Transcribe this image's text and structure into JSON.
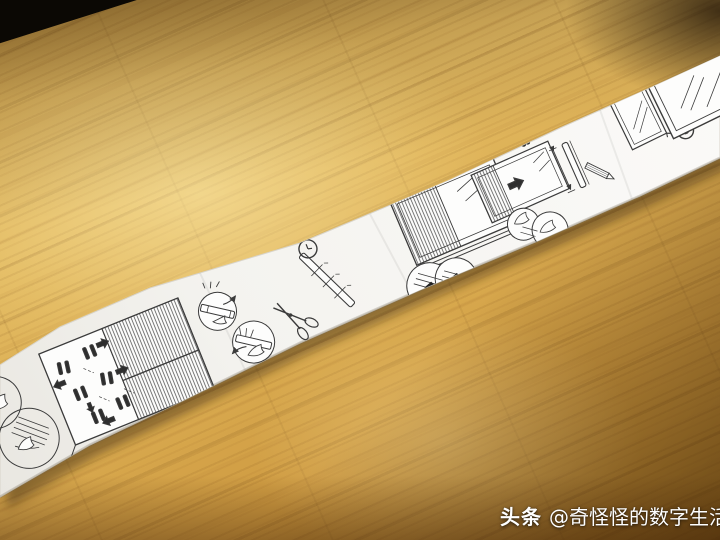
{
  "watermark": {
    "brand": "头条",
    "handle": "@奇怪怪的数字生活"
  },
  "strip": {
    "description_visible_steps": "printed assembly-instruction strip for a pleated window blind",
    "step_numbers": {
      "step2": "2",
      "step3": "3",
      "step4": "4"
    },
    "paper_color": "#f6f5f1",
    "ink_color": "#3b3b3b"
  },
  "wood": {
    "highlight": "#eed084",
    "mid": "#d9ad55",
    "dark": "#b9852f",
    "corner_shadow": "#3a2410",
    "void_corner": "#0b0804"
  }
}
